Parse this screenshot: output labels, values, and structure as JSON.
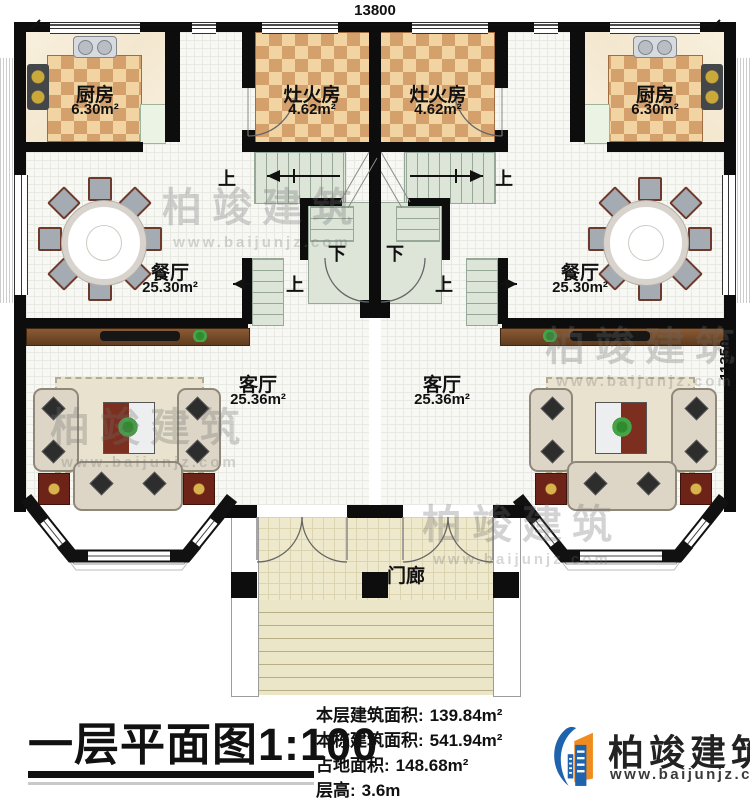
{
  "plan": {
    "dim_top": "13800",
    "dim_right": "11350",
    "rooms": {
      "kitchen": {
        "name": "厨房",
        "area": "6.30m²"
      },
      "stove_room": {
        "name": "灶火房",
        "area": "4.62m²"
      },
      "dining": {
        "name": "餐厅",
        "area": "25.30m²"
      },
      "living": {
        "name": "客厅",
        "area": "25.36m²"
      },
      "porch": {
        "name": "门廊"
      }
    },
    "stairs": {
      "up": "上",
      "down": "下"
    }
  },
  "title_block": {
    "title": "一层平面图",
    "scale": "1:100",
    "stats": [
      {
        "label": "本层建筑面积:",
        "value": "139.84m²"
      },
      {
        "label": "本栋建筑面积:",
        "value": "541.94m²"
      },
      {
        "label": "占地面积:",
        "value": "148.68m²"
      },
      {
        "label": "层高:",
        "value": "3.6m"
      }
    ]
  },
  "brand": {
    "name": "柏竣建筑",
    "url": "www.baijunjz.com"
  },
  "watermark": {
    "name": "柏竣建筑",
    "url": "www.baijunjz.com"
  }
}
